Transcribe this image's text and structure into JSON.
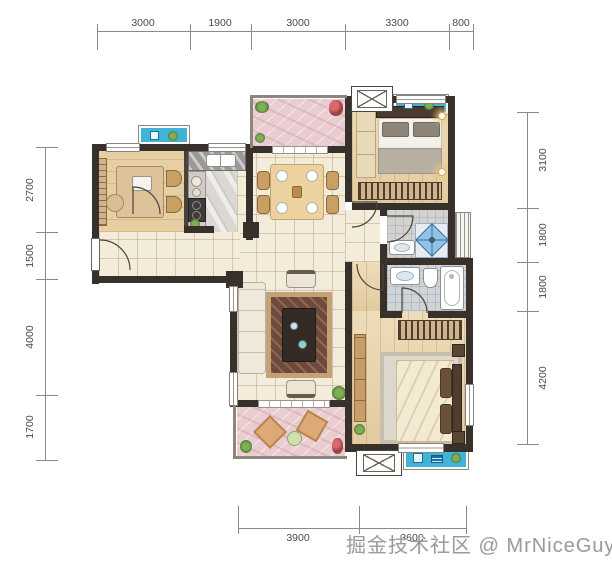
{
  "watermark": {
    "text": "掘金技术社区 @ MrNiceGuy"
  },
  "dimensions": {
    "top": [
      "3000",
      "1900",
      "3000",
      "3300",
      "800"
    ],
    "left": [
      "2700",
      "1500",
      "4000",
      "1700"
    ],
    "right": [
      "3100",
      "1800",
      "1800",
      "4200"
    ],
    "bottom": [
      "3900",
      "3600"
    ]
  },
  "units": "mm",
  "colors": {
    "wall": "#38302a",
    "balcony_blue": "#41b2d8",
    "balcony_pink": "#e9cdd1",
    "wood_floor": "#ead5ab",
    "tile_floor": "#f3ecdb",
    "dimension_text": "#4b4b4b",
    "watermark_text": "#9b9b9b",
    "shower_glass": "#8fc3e8"
  },
  "icons": {
    "ac-unit-icon": "box with X",
    "plant-icon": "green circle",
    "washer-icon": "white square",
    "drying-rack-icon": "striped blue square",
    "shower-icon": "blue diamond with X"
  }
}
